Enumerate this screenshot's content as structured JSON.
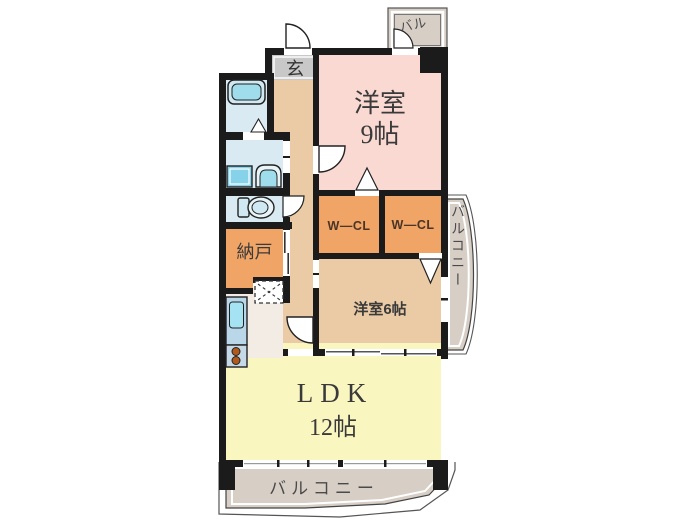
{
  "plan": {
    "title": "apartment-floor-plan",
    "rooms": {
      "entrance": {
        "label": "玄"
      },
      "western9": {
        "label": "洋室",
        "size": "9帖"
      },
      "wcl1": {
        "label": "W—CL"
      },
      "wcl2": {
        "label": "W—CL"
      },
      "western6": {
        "label": "洋室6帖"
      },
      "storage": {
        "label": "納戸"
      },
      "ldk": {
        "label": "LDK",
        "size": "12帖"
      }
    },
    "balconies": {
      "top": {
        "label": "バル"
      },
      "right": {
        "label": "バルコニー"
      },
      "bottom": {
        "label": "バルコニー"
      }
    },
    "colors": {
      "wall": "#1b1b1b",
      "bedroom_pink": "#F9D9D1",
      "closet_orange": "#F0A466",
      "bedroom_tan": "#EBCBA5",
      "hallway_tan": "#EBCBA5",
      "ldk_yellow": "#FAF6C0",
      "balcony_gray": "#D7CEC6",
      "entrance_gray": "#C8C8C8",
      "wetroom_blue": "#DAEAF3",
      "fixture_cyan": "#9FDCEC",
      "kitchen_floor": "#F3ECE4",
      "stove_burner": "#B05A1E"
    }
  }
}
